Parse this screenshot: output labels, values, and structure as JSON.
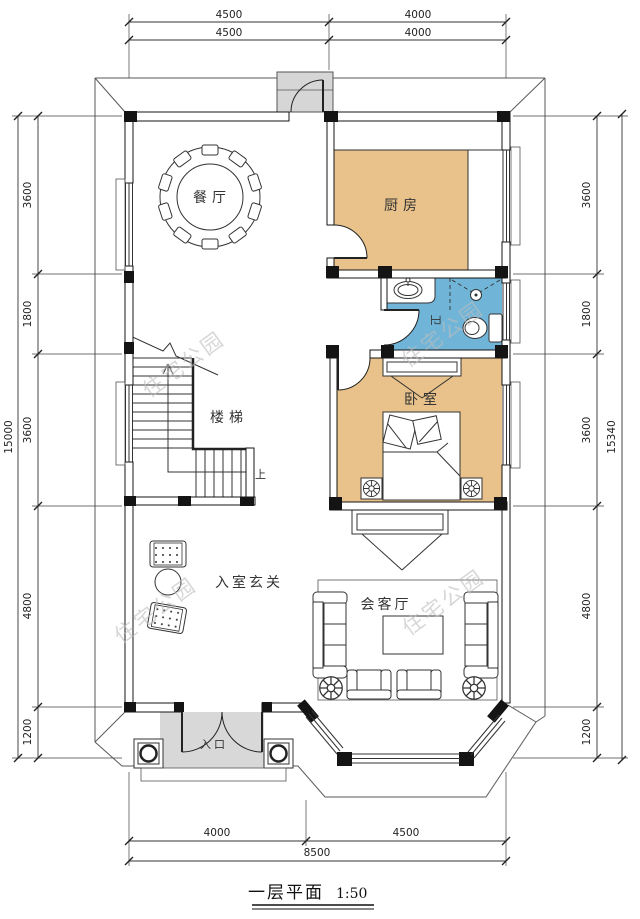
{
  "title": {
    "text": "一层平面",
    "scale": "1:50"
  },
  "watermark": "住宅公园",
  "rooms": {
    "dining": "餐厅",
    "kitchen": "厨房",
    "bath": "卫",
    "bedroom": "卧室",
    "stairs": "楼梯",
    "stairs_up": "上",
    "foyer": "入室玄关",
    "living": "会客厅",
    "entrance": "入口"
  },
  "dimensions": {
    "top_row1": [
      "4500",
      "4000"
    ],
    "top_row2": [
      "4500",
      "4000"
    ],
    "left_segments": [
      "3600",
      "1800",
      "3600",
      "4800",
      "1200"
    ],
    "left_total": "15000",
    "right_segments": [
      "3600",
      "1800",
      "3600",
      "4800",
      "1200"
    ],
    "right_total": "15340",
    "bottom_row1": [
      "4000",
      "4500"
    ],
    "bottom_total": "8500"
  },
  "colors": {
    "room_fill": "#E8C28A",
    "bath_fill": "#70B5D8",
    "porch_fill": "#D8D8D8",
    "landing_fill": "#D6D6D6"
  }
}
